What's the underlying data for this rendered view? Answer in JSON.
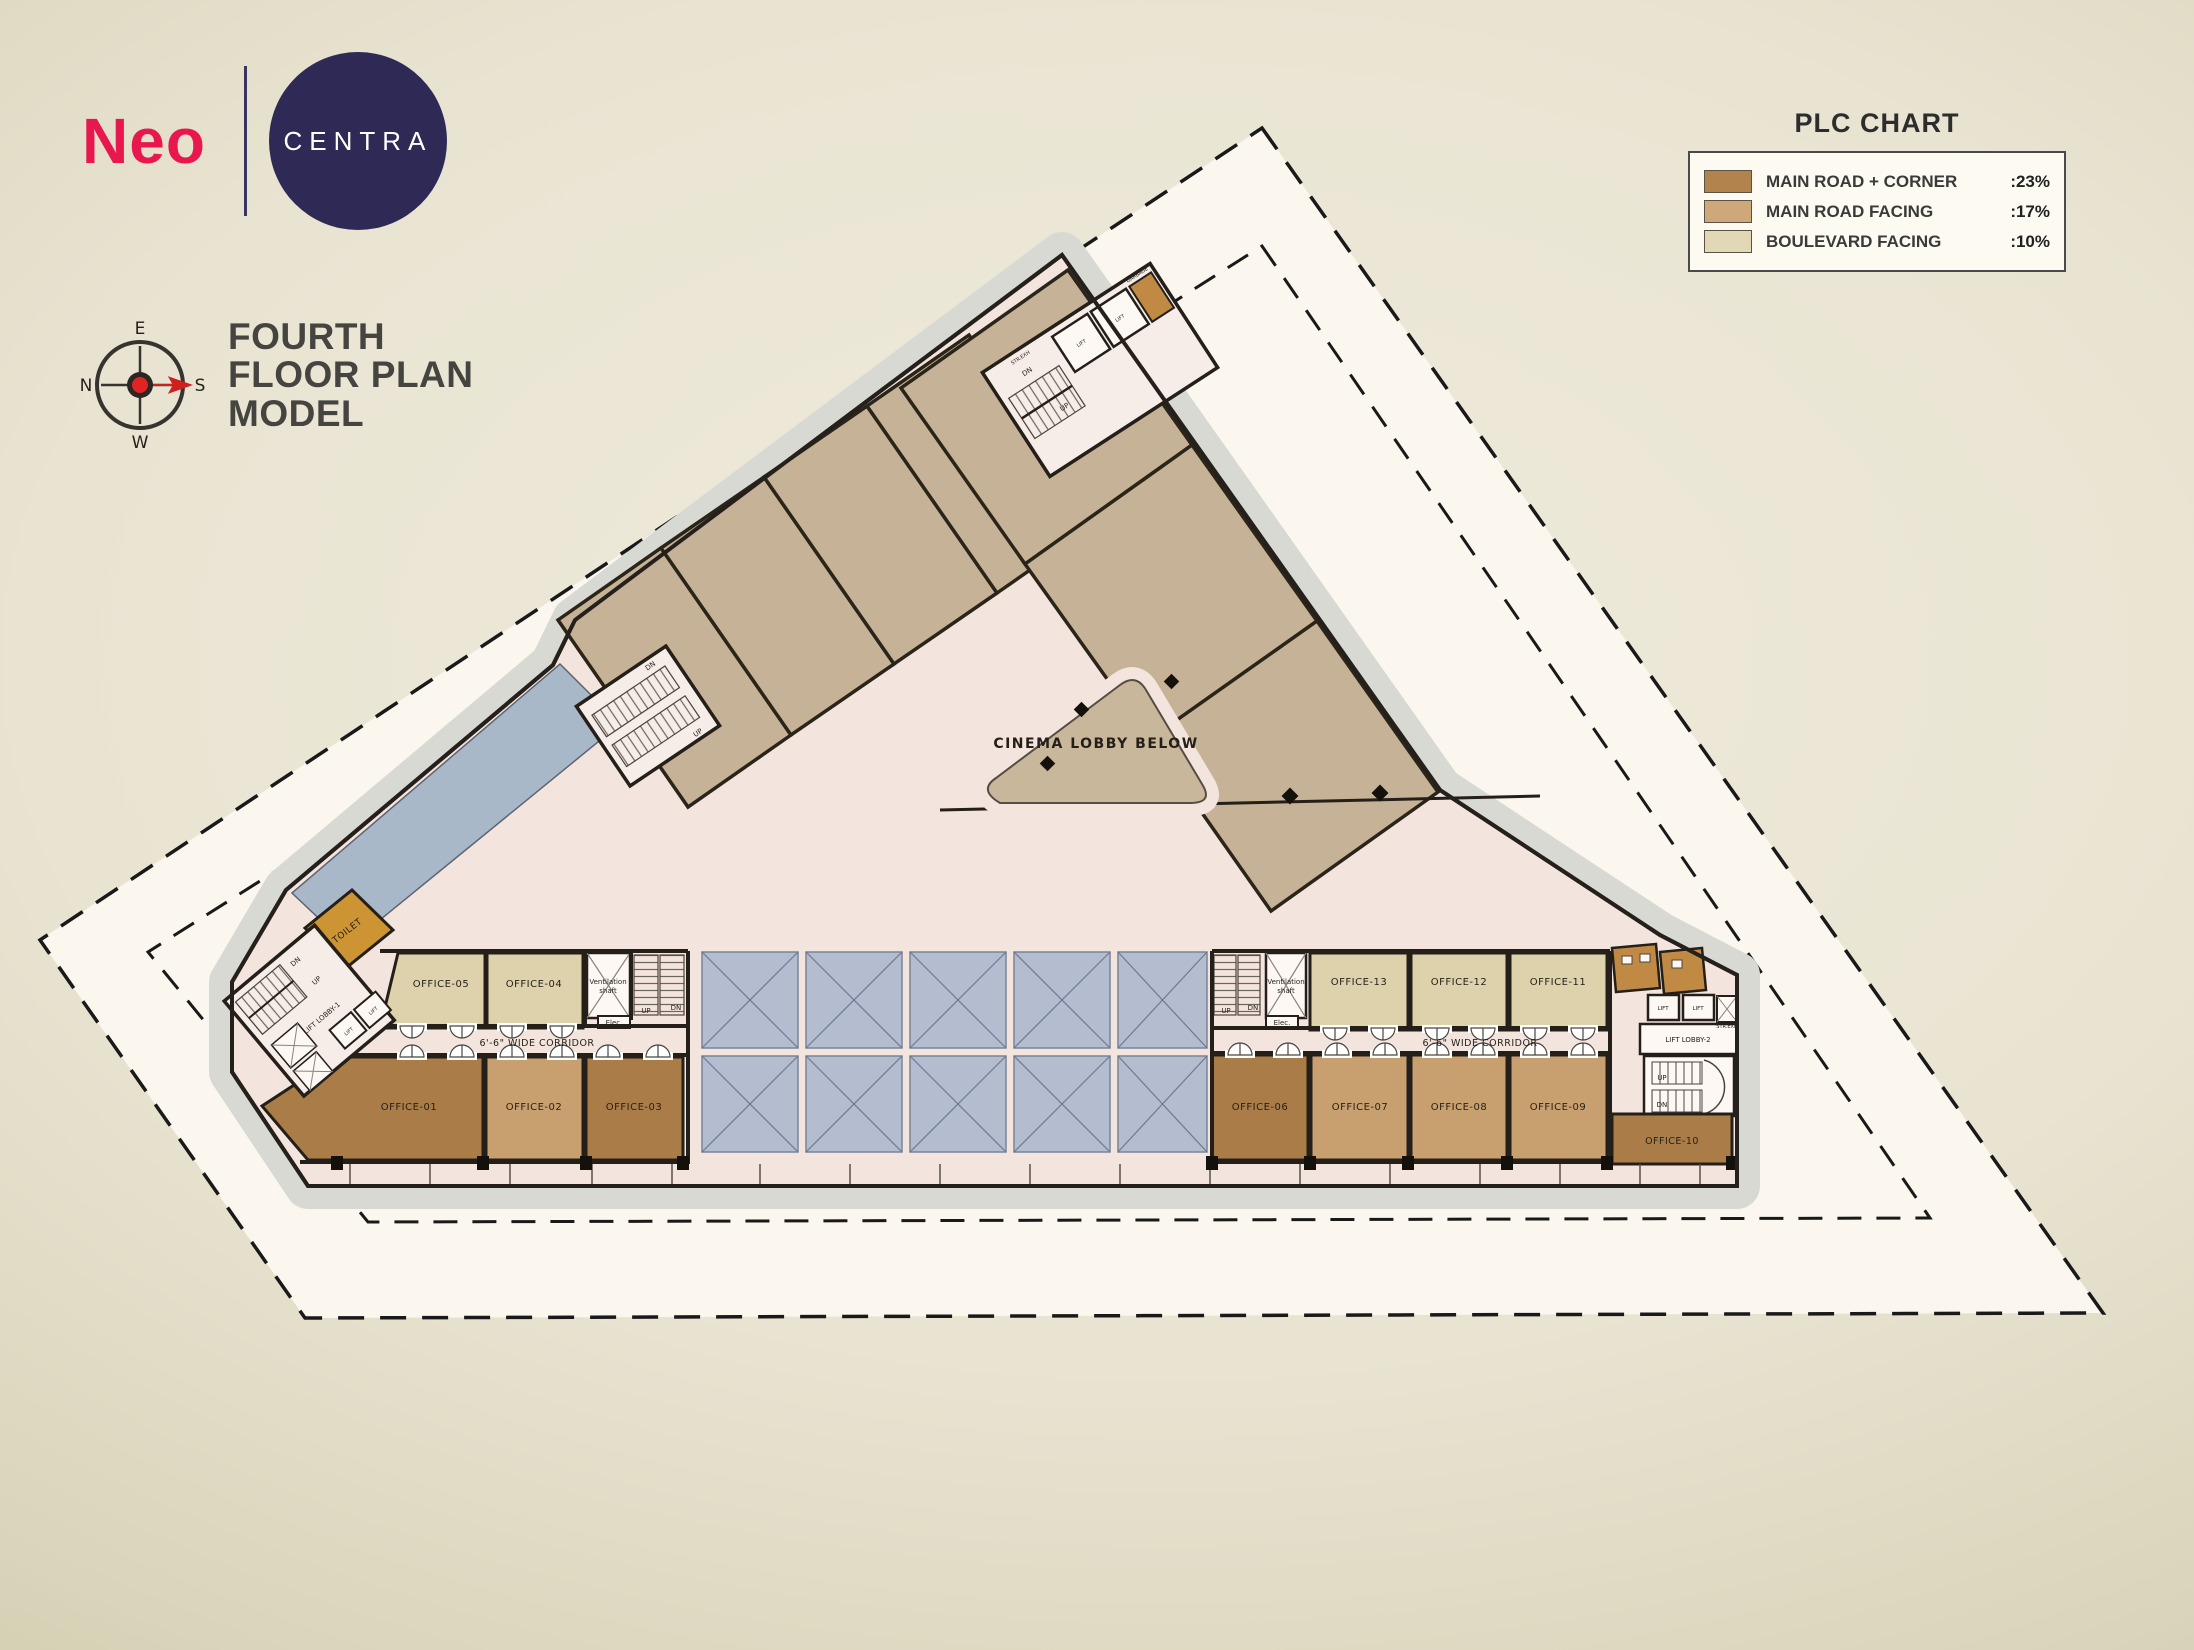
{
  "branding": {
    "logo_primary": "Neo",
    "logo_secondary": "CENTRA"
  },
  "title": {
    "line1": "FOURTH",
    "line2": "FLOOR PLAN",
    "line3": "MODEL"
  },
  "compass": {
    "top": "E",
    "right": "S",
    "bottom": "W",
    "left": "N"
  },
  "plc_chart": {
    "title": "PLC CHART",
    "rows": [
      {
        "label": "MAIN ROAD + CORNER",
        "value": ":23%",
        "color": "#b3834e"
      },
      {
        "label": "MAIN ROAD FACING",
        "value": ":17%",
        "color": "#cfa87a"
      },
      {
        "label": "BOULEVARD FACING",
        "value": ":10%",
        "color": "#e3d8b6"
      }
    ]
  },
  "plan": {
    "offices": [
      "OFFICE-01",
      "OFFICE-02",
      "OFFICE-03",
      "OFFICE-04",
      "OFFICE-05",
      "OFFICE-06",
      "OFFICE-07",
      "OFFICE-08",
      "OFFICE-09",
      "OFFICE-10",
      "OFFICE-11",
      "OFFICE-12",
      "OFFICE-13"
    ],
    "corridor": "6'-6\" WIDE CORRIDOR",
    "cinema_lobby": "CINEMA LOBBY BELOW",
    "toilet": "TOILET",
    "lift_lobby_1": "LIFT LOBBY-1",
    "lift_lobby_2": "LIFT LOBBY-2",
    "vent_line1": "Ventilation",
    "vent_line2": "shaft",
    "elec": "Elec.",
    "up": "UP",
    "dn": "DN",
    "lift": "LIFT",
    "garbage": "GARBAGE",
    "str_exh": "STR.EXH",
    "colors": {
      "main_road_corner": "#aa7c47",
      "main_road_facing": "#c89f6e",
      "boulevard_facing": "#ddd2ab",
      "wing_room": "#c6b296",
      "terrace": "#a9b8c9",
      "atrium_panel": "#b3bdcf",
      "toilet_room": "#cd9434",
      "accent_logo": "#e8184f",
      "accent_disc": "#2e2a55"
    }
  }
}
